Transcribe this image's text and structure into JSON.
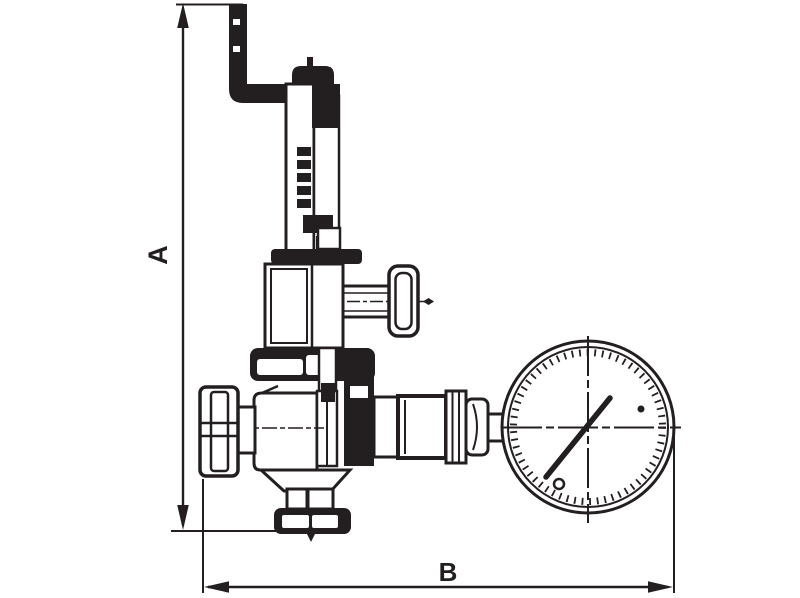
{
  "drawing": {
    "kind": "valve-dimension-diagram",
    "labels": {
      "dimension_vertical": "A",
      "dimension_horizontal": "B"
    },
    "colors": {
      "ink": "#231f20",
      "background": "#ffffff"
    },
    "parts": {
      "discharge_pipe": "bent-discharge-pipe",
      "spring_housing": "spring-housing-tube",
      "bonnet": "bonnet",
      "side_knob": "side-outlet-knob",
      "inlet_port": "inlet-port",
      "body": "valve-body",
      "outlet_flange": "bottom-outlet-flange",
      "gauge": "pressure-gauge",
      "gauge_needle": "gauge-needle"
    }
  }
}
